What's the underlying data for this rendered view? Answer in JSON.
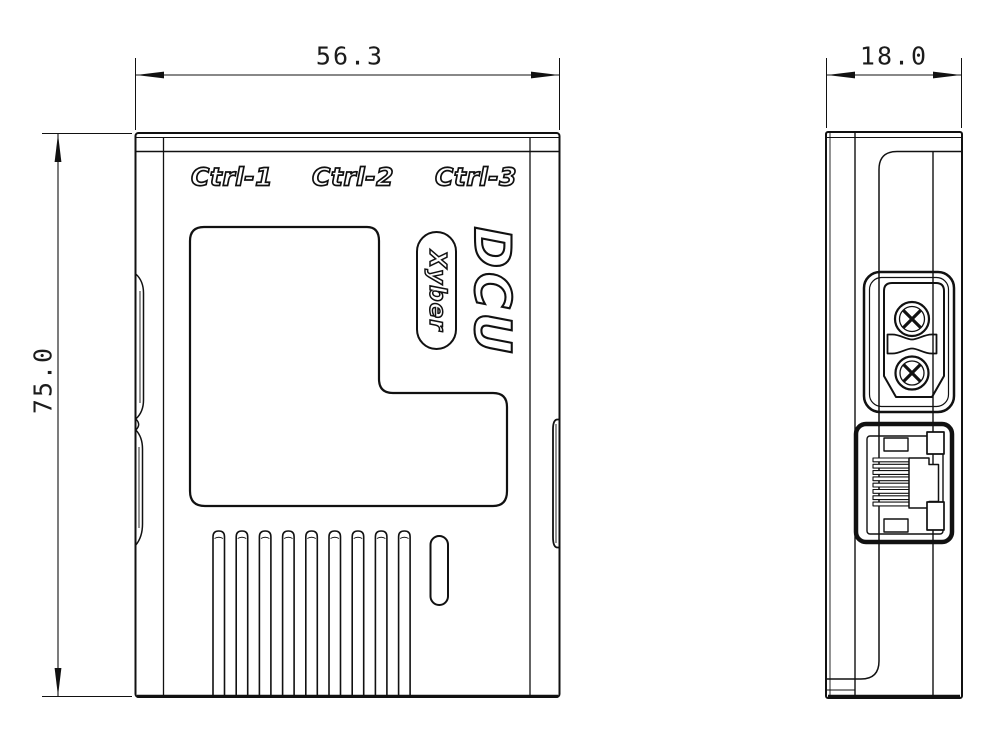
{
  "drawing": {
    "front_view": {
      "port_labels": {
        "ctrl1": "Ctrl-1",
        "ctrl2": "Ctrl-2",
        "ctrl3": "Ctrl-3"
      },
      "product_logo": "DCU",
      "brand": "Xyber",
      "width_dim": "56.3",
      "height_dim": "75.0"
    },
    "side_view": {
      "depth_dim": "18.0"
    },
    "colors": {
      "line": "#111111",
      "background": "#ffffff"
    }
  }
}
